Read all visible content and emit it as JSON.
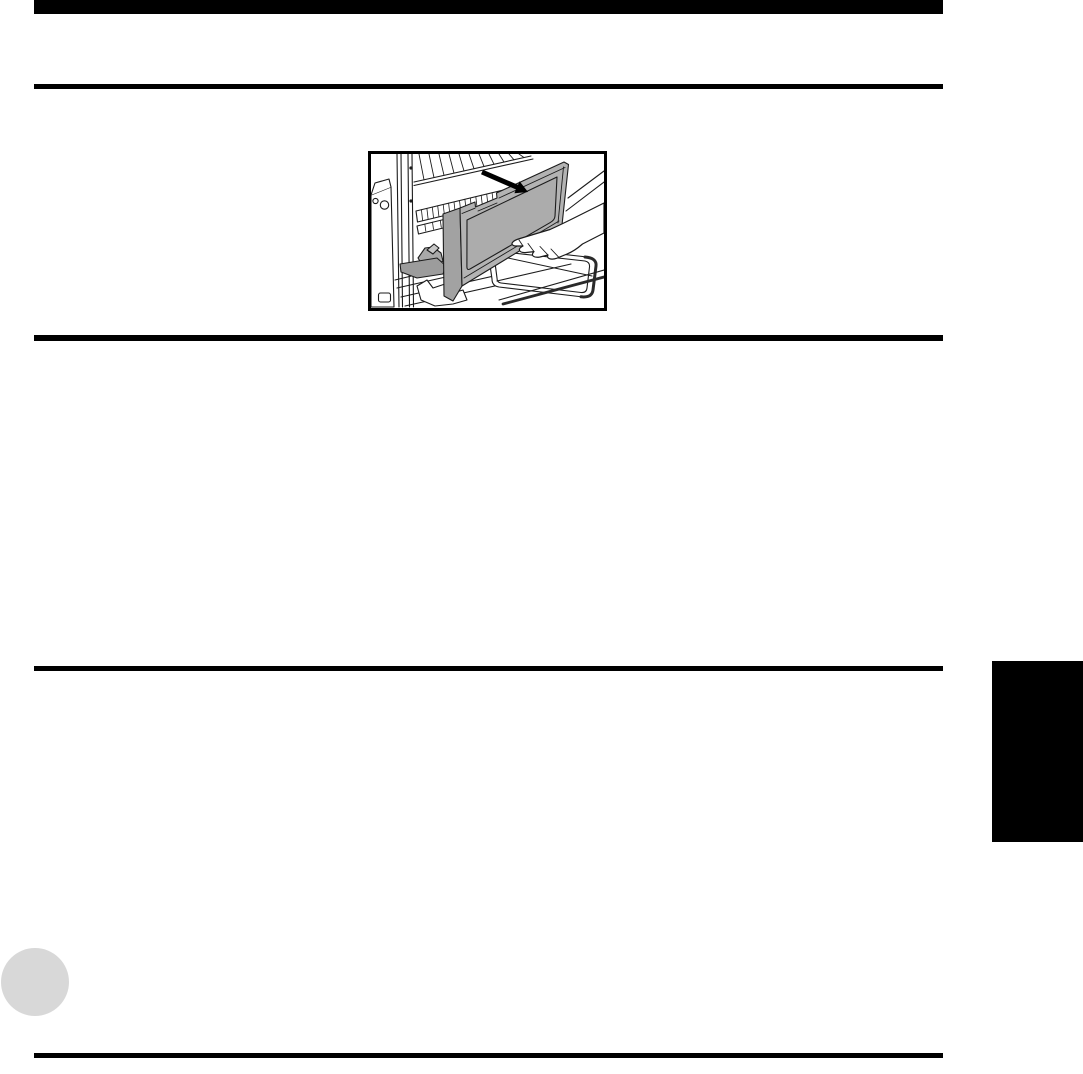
{
  "page": {
    "background_color": "#ffffff"
  },
  "header": {
    "top_bar_color": "#000000",
    "rule_color": "#000000"
  },
  "dividers": {
    "color": "#000000"
  },
  "figure": {
    "description": "Line-art illustration of a hand pulling a gray cover panel off the side of a printer; a solid black arrow on top of the cover points toward the lower right showing the removal direction; an output tray and slide rails are below.",
    "border_color": "#000000",
    "background_color": "#ffffff",
    "line_color": "#1c1c1c",
    "cover_color": "#b3b3b3",
    "cover_cap_color": "#a2a2a2",
    "cover_panel_color": "#acacac",
    "cover_lip_color": "#c8c8c8",
    "lever_color": "#a9a9a9",
    "lever_arm_color": "#9c9c9c",
    "tray_edge_color": "#2a2a2a",
    "arrow_color": "#000000"
  },
  "side_tab": {
    "color": "#000000"
  },
  "page_number_marker": {
    "color": "#d8d8d8"
  },
  "footer": {
    "rule_color": "#000000"
  }
}
